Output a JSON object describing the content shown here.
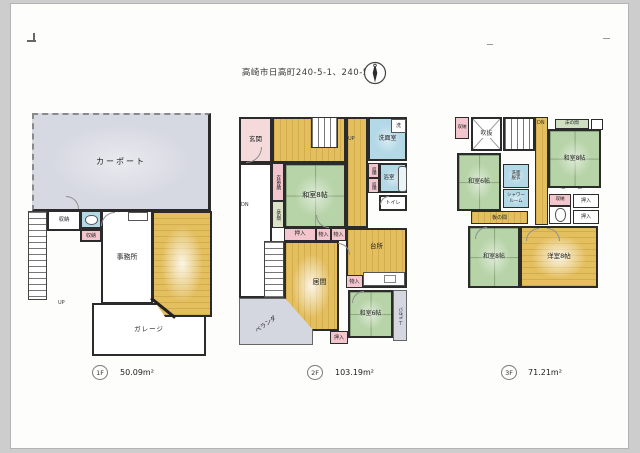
{
  "title": "高崎市日高町240-5-1、240-5-2",
  "compass": {
    "name": "north-arrow"
  },
  "colors": {
    "wall": "#2b2b2b",
    "tatami_green": "#b7d3a8",
    "wood_yellow": "#e4bf5e",
    "closet_pink": "#f3c6ce",
    "water_blue": "#b3d8e6",
    "outdoor_gray": "#d5d7e0"
  },
  "floor1": {
    "badge": "1F",
    "area": "50.09m²",
    "rooms": {
      "carport": "カーポート",
      "storage_a": "収納",
      "storage_b": "収納",
      "office": "事務所",
      "garage": "ガレージ",
      "up": "UP"
    }
  },
  "floor2": {
    "badge": "2F",
    "area": "103.19m²",
    "rooms": {
      "genkan": "玄関",
      "up": "UP",
      "dn": "DN",
      "washer": "洗",
      "senmenshitsu": "洗面室",
      "shuno_a": "収納",
      "shuno_b": "収納",
      "yokushitsu": "浴室",
      "toilet": "トイレ",
      "isho_shuno": "衣装収納",
      "tokonoma": "床の間",
      "washitsu8": "和室8帖",
      "oshiire_a": "押入",
      "monoire_a": "物入",
      "monoire_b": "物入",
      "ima": "居間",
      "daidokoro": "台所",
      "monoire_c": "物入",
      "washitsu6": "和室6帖",
      "balcony": "バルコニー",
      "oshiire_b": "押入",
      "veranda": "ベランダ"
    }
  },
  "floor3": {
    "badge": "3F",
    "area": "71.21m²",
    "rooms": {
      "shuno_a": "収納",
      "fukinuke": "吹抜",
      "dn": "DN",
      "tokonoma": "床の間",
      "washitsu6": "和室6帖",
      "washitsu8_a": "和室8帖",
      "senmen_datsui": "洗面脱衣",
      "shower_room": "シャワールーム",
      "itanoma": "板の間",
      "shuno_b": "収納",
      "oshiire_a": "押入",
      "oshiire_b": "押入",
      "washitsu8_b": "和室8帖",
      "youshitsu8": "洋室8帖"
    }
  }
}
